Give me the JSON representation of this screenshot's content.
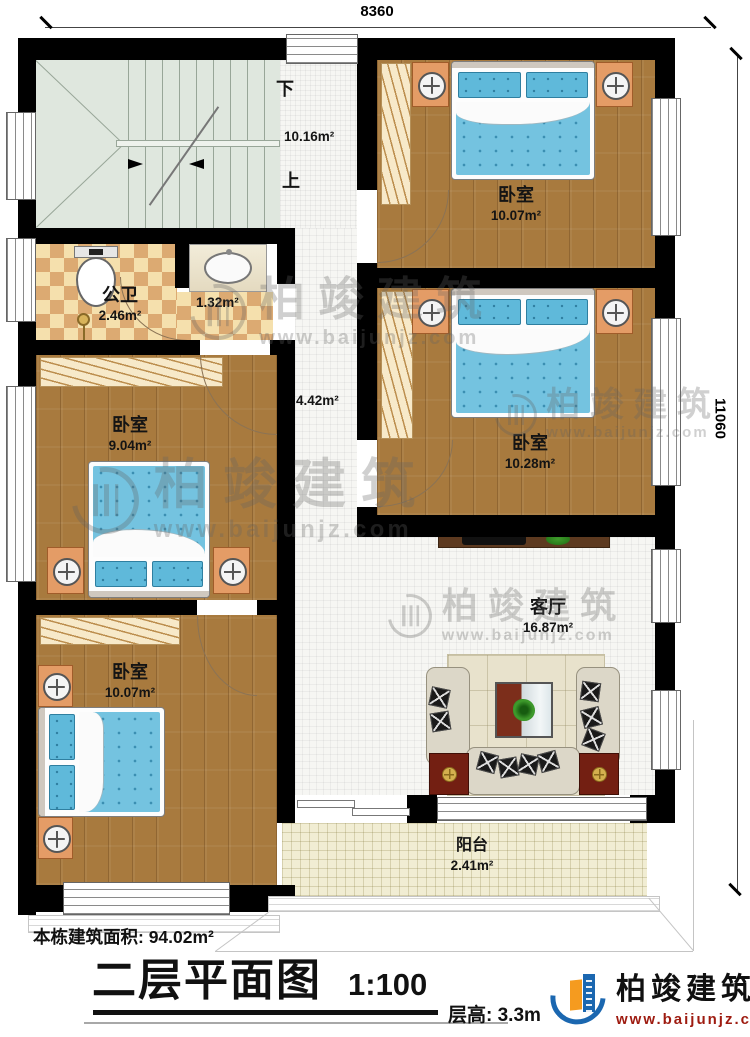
{
  "dimensions": {
    "top_width": "8360",
    "right_height": "11060"
  },
  "stairs": {
    "down_label": "下",
    "up_label": "上"
  },
  "rooms": [
    {
      "id": "bedroom-top-right",
      "name": "卧室",
      "area": "10.07m²"
    },
    {
      "id": "bedroom-middle-right",
      "name": "卧室",
      "area": "10.28m²"
    },
    {
      "id": "bedroom-left",
      "name": "卧室",
      "area": "9.04m²"
    },
    {
      "id": "bedroom-bottom-left",
      "name": "卧室",
      "area": "10.07m²"
    },
    {
      "id": "bathroom",
      "name": "公卫",
      "area": "2.46m²"
    },
    {
      "id": "washbasin-nook",
      "name": "",
      "area": "1.32m²"
    },
    {
      "id": "stair-hall",
      "name": "",
      "area": "10.16m²"
    },
    {
      "id": "corridor",
      "name": "",
      "area": "4.42m²"
    },
    {
      "id": "living-room",
      "name": "客厅",
      "area": "16.87m²"
    },
    {
      "id": "balcony",
      "name": "阳台",
      "area": "2.41m²"
    }
  ],
  "title_block": {
    "building_area": "本栋建筑面积: 94.02m²",
    "title": "二层平面图",
    "scale": "1:100",
    "floor_height": "层高: 3.3m"
  },
  "branding": {
    "company": "柏竣建筑",
    "website": "www.baijunjz.com"
  },
  "colors": {
    "wall": "#000000",
    "wood_floor": "#a87a3e",
    "bed_blue": "#74c3e0",
    "checker_dark": "#dcaa72",
    "checker_light": "#f5e0ad",
    "stairs": "#dfe7de",
    "balcony": "#f1edd3",
    "logo_blue": "#1b67b0",
    "logo_orange": "#f59b1f",
    "website_red": "#9e1b10"
  }
}
